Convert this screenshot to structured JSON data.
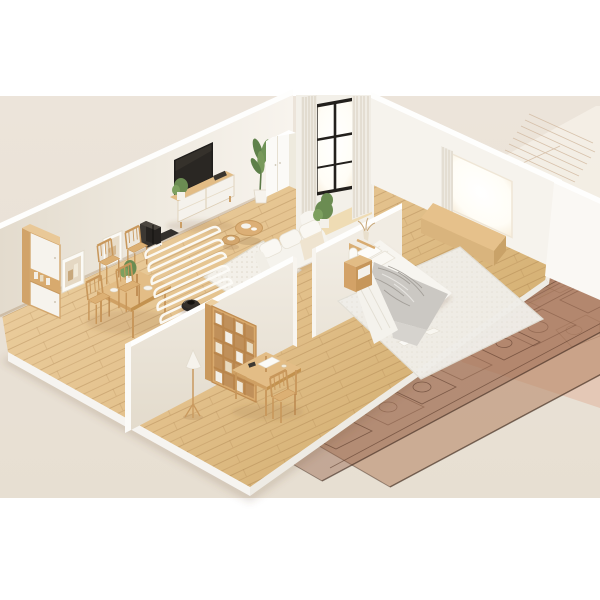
{
  "meta": {
    "title": "Isometric apartment cutaway with robot vacuum cleaning route",
    "render_type": "3d-product-render",
    "canvas": "600x600"
  },
  "labels": {
    "figure": "3D cutaway model of an apartment standing on architectural blueprint sheets; a black robot vacuum traces a white serpentine cleaning path across the wooden living-room floor",
    "living_room": "living and dining room",
    "bedroom": "bedroom",
    "robot": "robot vacuum",
    "dock": "charging dock station",
    "path": "serpentine cleaning path",
    "blueprints": "translucent blueprint floor-plan sheets"
  },
  "palette": {
    "backdrop": "#ffffff",
    "stage_beige": "#e9e1d6",
    "wood_floor_light": "#ecd0a3",
    "wood_floor_dark": "#d8b67c",
    "wall_lit": "#f7f3ec",
    "wall_shadow": "#e4dccf",
    "wall_cap": "#fefefd",
    "wood_furniture": "#d8a96b",
    "white_furniture": "#f6f3ed",
    "tv_black": "#1f1d1b",
    "robot_black": "#2b2826",
    "path_white": "#fcfbf7",
    "blanket_gray": "#cbc8c3",
    "plant_green": "#6b8c52",
    "blueprint_brown": "#b98f72",
    "blueprint_pink": "#e5cbbb",
    "blueprint_line": "#7d5a45"
  },
  "scene": {
    "rooms": [
      {
        "name": "living-dining room",
        "items": [
          "tall cabinet",
          "two wall frames",
          "dining table",
          "four dining chairs",
          "wall tv",
          "tv sideboard",
          "tall plant",
          "white wardrobe",
          "balcony window with curtains",
          "white sofa",
          "area rug",
          "two round coffee tables",
          "robot dock",
          "robot vacuum",
          "serpentine cleaning path"
        ]
      },
      {
        "name": "bedroom",
        "items": [
          "double bed",
          "gray crumpled blanket",
          "pillows",
          "headboard",
          "nightstand with lamp",
          "bedroom rug",
          "window with wooden seat",
          "curtain",
          "bookshelf",
          "writing desk",
          "desk chair",
          "floor lamp"
        ]
      }
    ],
    "props": {
      "blueprint_sheets": 4,
      "cleaning_path_runs": 7
    }
  }
}
